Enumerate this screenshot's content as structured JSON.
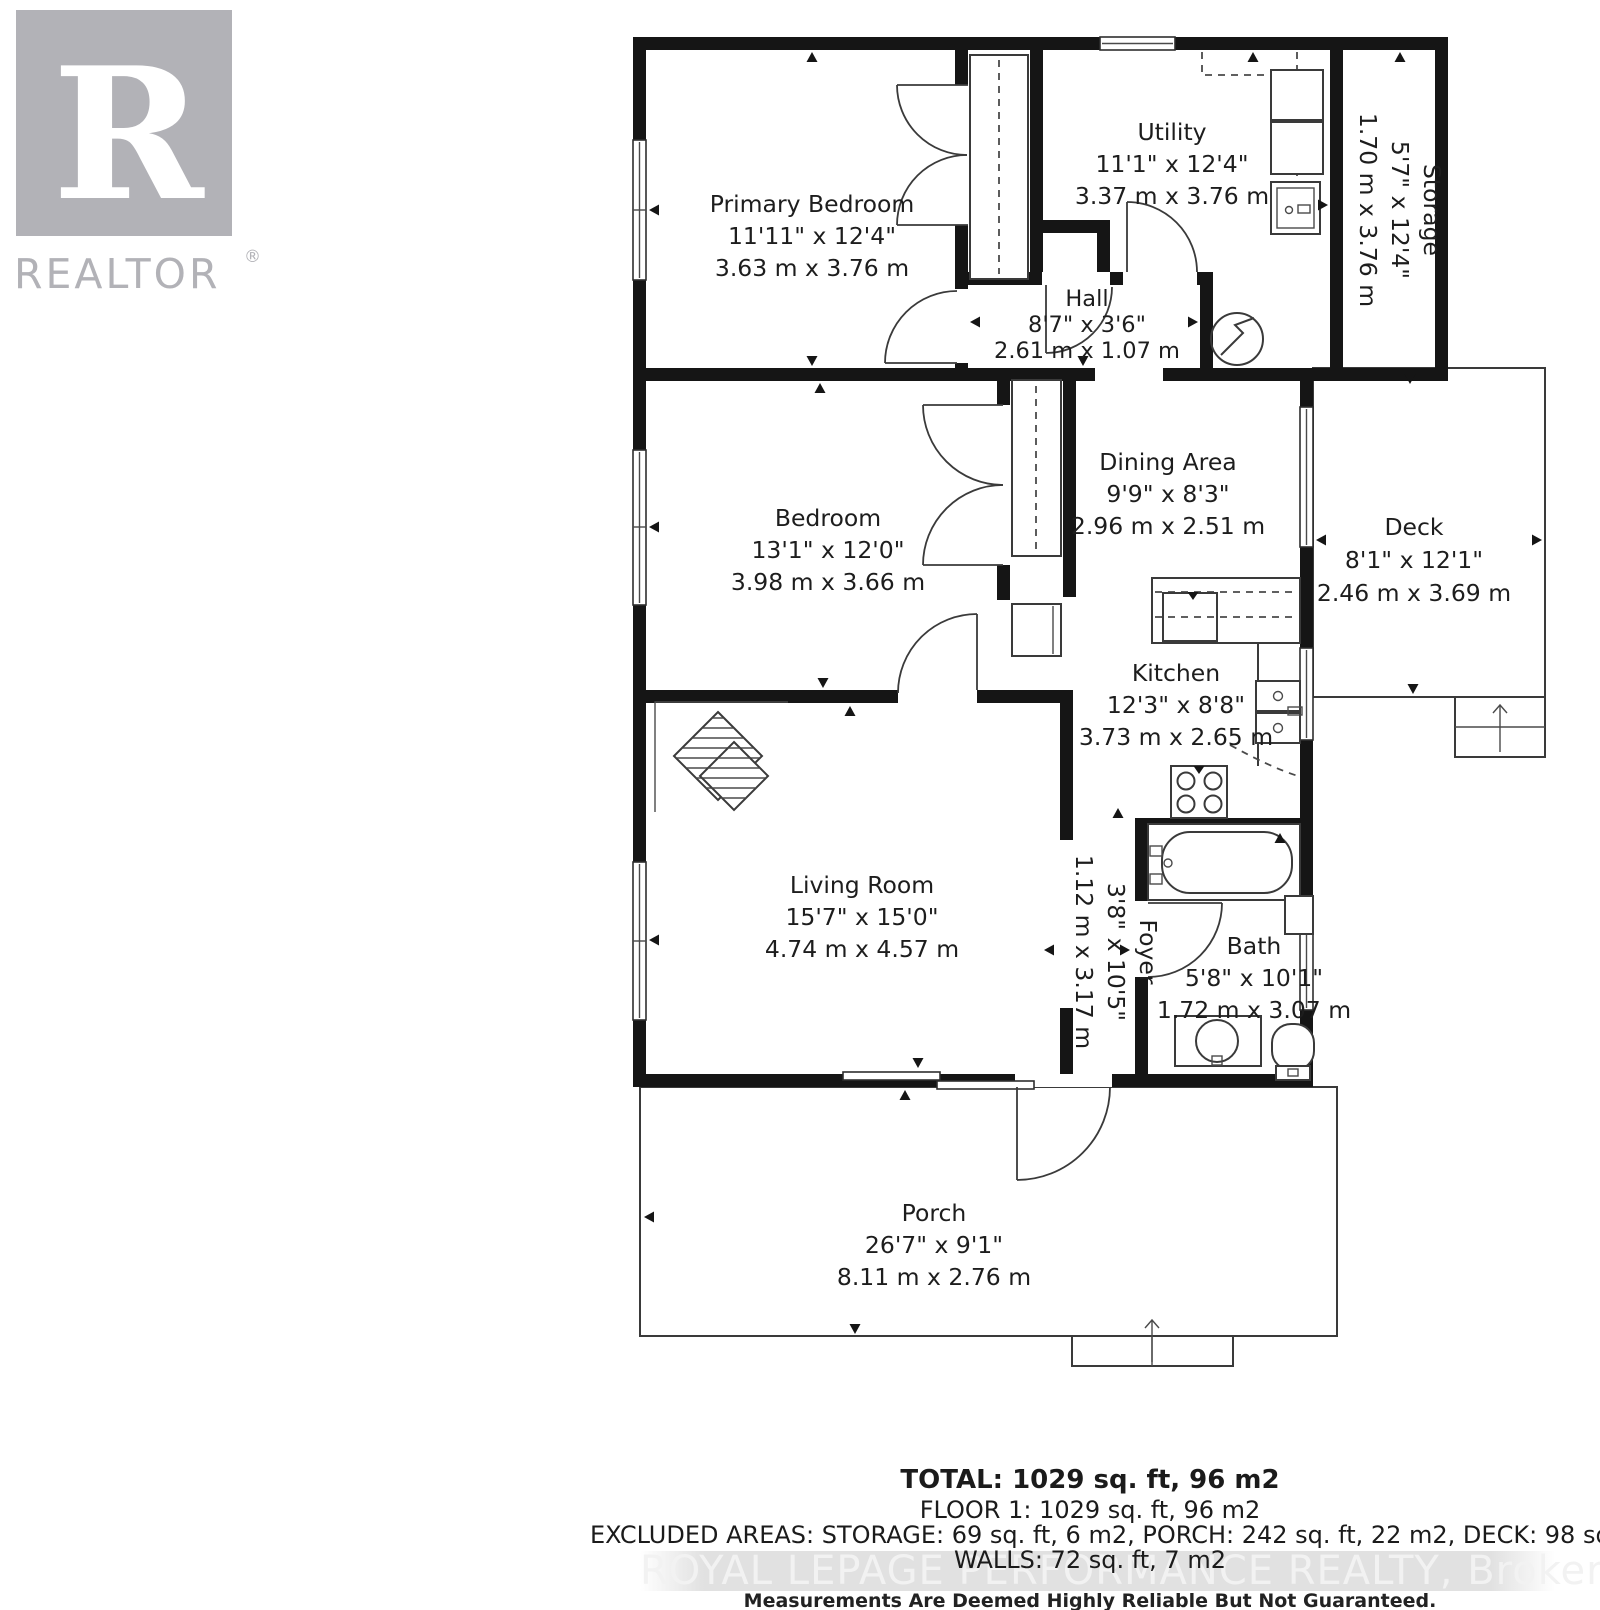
{
  "logo": {
    "letter": "R",
    "wordmark": "REALTOR",
    "registered": "®"
  },
  "rooms": [
    {
      "id": "primary-bedroom",
      "name": "Primary Bedroom",
      "imperial": "11'11\" x 12'4\"",
      "metric": "3.63 m x 3.76 m"
    },
    {
      "id": "utility",
      "name": "Utility",
      "imperial": "11'1\" x 12'4\"",
      "metric": "3.37 m x 3.76 m"
    },
    {
      "id": "storage",
      "name": "Storage",
      "imperial": "5'7\" x 12'4\"",
      "metric": "1.70 m x 3.76 m"
    },
    {
      "id": "hall",
      "name": "Hall",
      "imperial": "8'7\" x 3'6\"",
      "metric": "2.61 m x 1.07 m"
    },
    {
      "id": "bedroom",
      "name": "Bedroom",
      "imperial": "13'1\" x 12'0\"",
      "metric": "3.98 m x 3.66 m"
    },
    {
      "id": "dining-area",
      "name": "Dining Area",
      "imperial": "9'9\" x 8'3\"",
      "metric": "2.96 m x 2.51 m"
    },
    {
      "id": "deck",
      "name": "Deck",
      "imperial": "8'1\" x 12'1\"",
      "metric": "2.46 m x 3.69 m"
    },
    {
      "id": "kitchen",
      "name": "Kitchen",
      "imperial": "12'3\" x 8'8\"",
      "metric": "3.73 m x 2.65 m"
    },
    {
      "id": "living-room",
      "name": "Living Room",
      "imperial": "15'7\" x 15'0\"",
      "metric": "4.74 m x 4.57 m"
    },
    {
      "id": "foyer",
      "name": "Foyer",
      "imperial": "3'8\" x 10'5\"",
      "metric": "1.12 m x 3.17 m"
    },
    {
      "id": "bath",
      "name": "Bath",
      "imperial": "5'8\" x 10'1\"",
      "metric": "1.72 m x 3.07 m"
    },
    {
      "id": "porch",
      "name": "Porch",
      "imperial": "26'7\" x 9'1\"",
      "metric": "8.11 m x 2.76 m"
    }
  ],
  "footer": {
    "total": "TOTAL: 1029 sq. ft, 96 m2",
    "floor": "FLOOR 1: 1029 sq. ft, 96 m2",
    "excluded": "EXCLUDED AREAS: STORAGE: 69 sq. ft, 6 m2, PORCH: 242 sq. ft, 22 m2, DECK: 98 sq. ft, 9 m2",
    "walls": "WALLS: 72 sq. ft, 7 m2",
    "watermark": "ROYAL LEPAGE PERFORMANCE REALTY, Brokerage",
    "disclaimer": "Measurements Are Deemed Highly Reliable But Not Guaranteed."
  },
  "colors": {
    "wall": "#151515",
    "line": "#3a3a3a",
    "text": "#1d1d1d",
    "logo_gray": "#b2b2b7",
    "watermark_text": "#f2f2f2",
    "watermark_band": "#e1e1e1",
    "background": "#ffffff"
  }
}
